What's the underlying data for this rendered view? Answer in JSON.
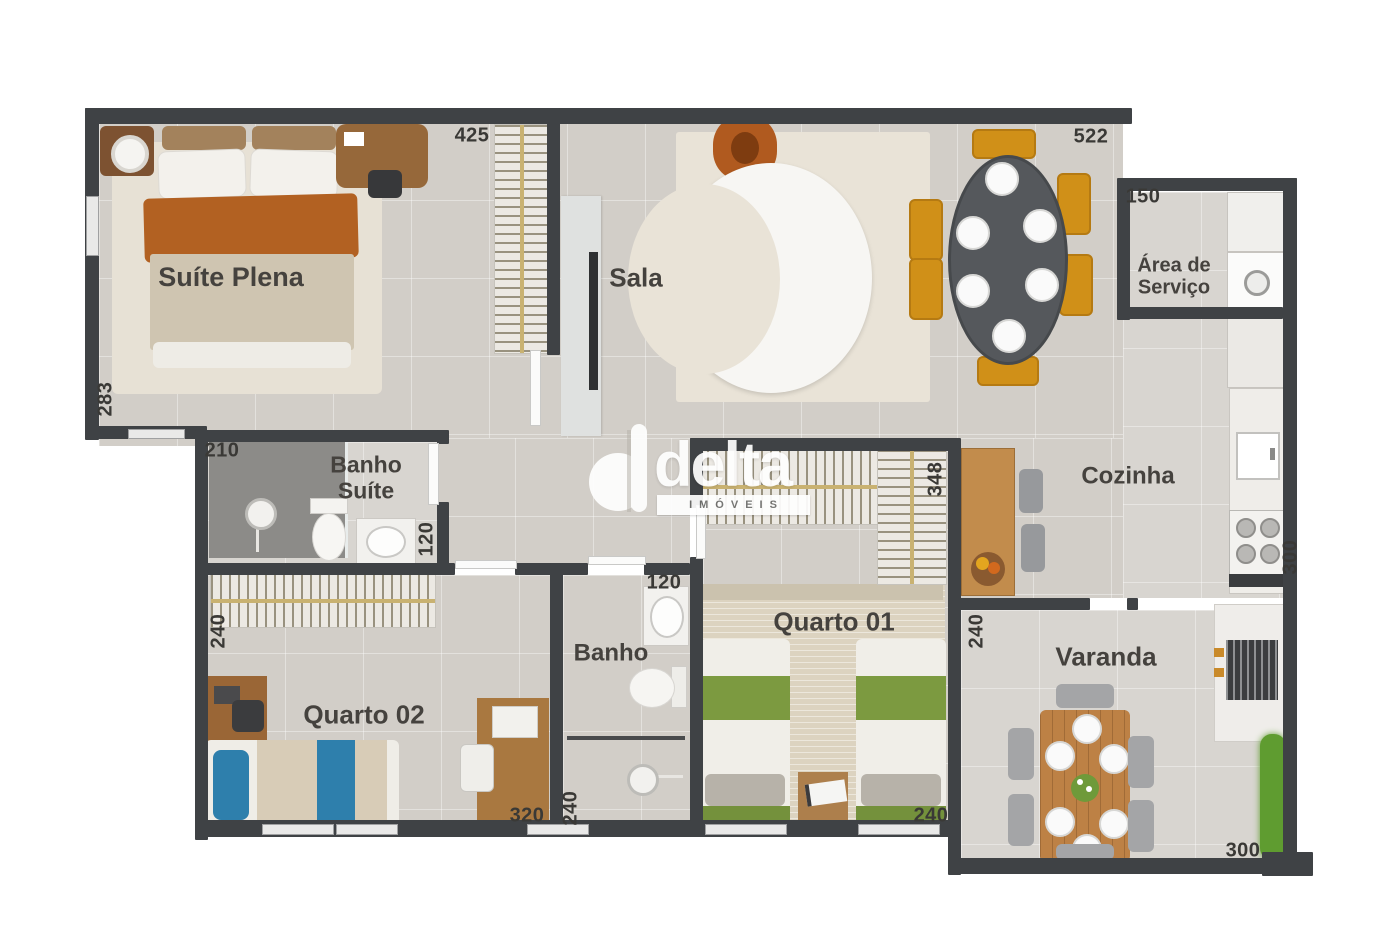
{
  "watermark": {
    "brand": "delta",
    "subtitle": "IMÓVEIS"
  },
  "rooms": {
    "suite_plena": "Suíte Plena",
    "sala": "Sala",
    "area_servico": "Área de Serviço",
    "cozinha": "Cozinha",
    "banho_suite": "Banho Suíte",
    "quarto_01": "Quarto 01",
    "quarto_02": "Quarto 02",
    "banho": "Banho",
    "varanda": "Varanda"
  },
  "dims": {
    "d425": "425",
    "d522": "522",
    "d150": "150",
    "d283": "283",
    "d210": "210",
    "d120_banho_suite": "120",
    "d348": "348",
    "d240_quarto02": "240",
    "d320": "320",
    "d120_banho": "120",
    "d240_banho": "240",
    "d240_quarto01": "240",
    "d240_varanda": "240",
    "d300_varanda": "300",
    "d300_cozinha": "300"
  },
  "colors": {
    "wall": "#3f4245",
    "floor": "#d2cec8",
    "wood": "#b5854f",
    "chair_mustard": "#d09018",
    "armchair_orange": "#b05a1f",
    "bed_green": "#7c9a40",
    "bed_blue": "#2e7fac",
    "sofa_white": "#f7f6f3"
  }
}
